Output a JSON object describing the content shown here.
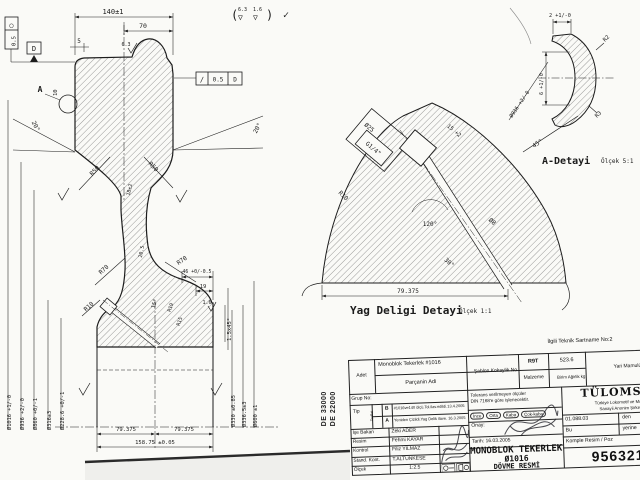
{
  "note": {
    "open": "(",
    "f1": "6.3",
    "f2": "1.6",
    "tri": "▽",
    "close": ")",
    "check": "✓"
  },
  "main_view": {
    "dim_140": "140±1",
    "dim_70": "70",
    "dim_5": "5",
    "dim_10": "10",
    "label_a": "A",
    "datum": "D",
    "frame_left_sym": "○",
    "frame_left_val": "0.5",
    "frame_right_sym": "∕",
    "frame_right_val": "0.5",
    "frame_right_datum": "D",
    "finish_top": "6.3",
    "angle_left": "20°",
    "angle_right": "20°",
    "r50_left": "R50",
    "r50_right": "R50",
    "web_top": "18±2",
    "web_bottom": "20.5",
    "r70_left": "R70",
    "r70_right": "R70",
    "r10": "R10",
    "dim_46": "46 +0/-0.5",
    "dim_19": "19",
    "finish_16": "1.6",
    "r19": "R19",
    "r15": "R15",
    "angle_15": "15°",
    "chamfer": "1.5x45°",
    "dia_left": [
      "Ø1016 +1/-0",
      "Ø936 +2/-0",
      "Ø860 +0/-1",
      "Ø316±3",
      "Ø228.6 +0/-1"
    ],
    "dia_right": [
      "Ø330 ±0.85",
      "Ø336.5±3",
      "Ø600 ±1"
    ],
    "dim_79_left": "79.375",
    "dim_79_right": "79.375",
    "dim_158": "158.75 ±0.05"
  },
  "oil_detail": {
    "caption": "Yag Deligi Detayi",
    "scale": "Ölçek 1:1",
    "d25": "Ø25",
    "thread": "G1/4\"",
    "r10": "R10",
    "depth": "15 +2",
    "angle_120": "120°",
    "d8": "Ø8",
    "angle_30": "30°",
    "width": "79.375"
  },
  "a_detail": {
    "caption": "A-Detayi",
    "scale": "Ölçek 5:1",
    "t2": "2 +1/-0",
    "r2": "R2",
    "h6": "6 +1/-0",
    "dia": "Ø936 +2/-0",
    "r3": "R3",
    "a45": "45°"
  },
  "title_block": {
    "above_note": "İlgili Teknik Sartname No:2",
    "adet": "Adet",
    "part_name": "Monoblok Tekerlek #1016",
    "part_label": "Parçanin Adi",
    "grup": "Grup  No:",
    "tip": "Tip",
    "tadilat": "Tadilat",
    "revisions": [
      {
        "rev": "B",
        "text": "#1016ve140 ölçü.Tol.ilav.edildi.13.4.2005"
      },
      {
        "rev": "A",
        "text": "Yeniden Çizildi.Yag Delik ilave. 16.3.2005"
      }
    ],
    "people": [
      {
        "role": "İşe Bakan",
        "name": "Zeki ADER"
      },
      {
        "role": "Resim",
        "name": "Fehmi KAYAR"
      },
      {
        "role": "Kontrol",
        "name": "Filiz YILMAZ"
      },
      {
        "role": "Stand. Kont.",
        "name": "T.ALTUNKESE"
      }
    ],
    "scale_label": "Ölçek",
    "scale_value": "1:2.5",
    "sablon_label": "Şablon Kokaylik No",
    "malzeme_label": "Malzeme",
    "malzeme_value": "R9T",
    "birim_label": "Birim Ağirlik kg",
    "birim_value": "523.6",
    "tol_note1": "Tolerans verilmeyen ölçüler",
    "tol_note2": "DIN 7168'e göre işlenecektir.",
    "classes": [
      "İnce",
      "Orta",
      "Kaba",
      "Çok-kaba"
    ],
    "onay": "Onay:",
    "tarih": "Tarih: 16.03.2005",
    "title1": "MONOBLOK TEKERLEK",
    "title2": "Ø1016",
    "title3": "DÖVME RESMİ",
    "yari": "Yari Mamulün Tasnif No",
    "company": "TÜLOMSAŞ",
    "company_sub1": "Türkiye Lokomotif ve Motor",
    "company_sub2": "Sanayii Anonim Şirketi",
    "code": "01.088.03",
    "den": "den",
    "bu": "Bu",
    "yerine": "yerine",
    "komple": "Komple Resim / Poz",
    "drawing_no": "9563216",
    "side_code1": "DE 33000",
    "side_code2": "DE 22000"
  },
  "icons": {
    "finish_flag": "▽",
    "projection_symbol": "⊕"
  }
}
